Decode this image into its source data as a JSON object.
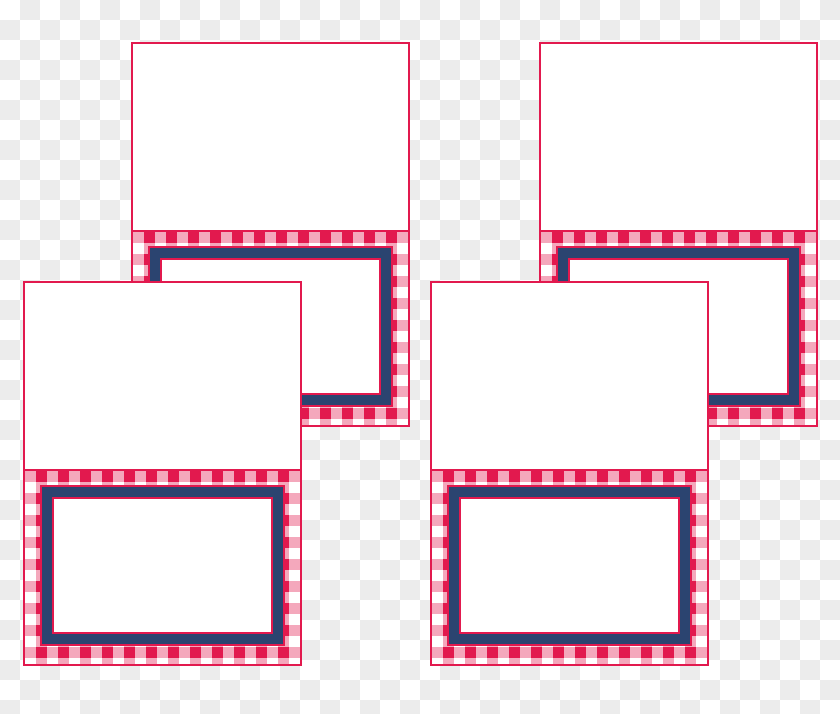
{
  "background": {
    "style": "png-transparency-checkerboard",
    "checker_size_px": 20
  },
  "palette": {
    "red": "#e2194e",
    "pink-weave": "rgba(226,25,78,0.38)",
    "navy": "#2b4470",
    "card-white": "#ffffff",
    "checker-light": "#ffffff",
    "checker-gray": "#ececec"
  },
  "cards": [
    {
      "id": "top-left",
      "name_text": ""
    },
    {
      "id": "top-right",
      "name_text": ""
    },
    {
      "id": "bottom-left",
      "name_text": ""
    },
    {
      "id": "bottom-right",
      "name_text": ""
    }
  ]
}
